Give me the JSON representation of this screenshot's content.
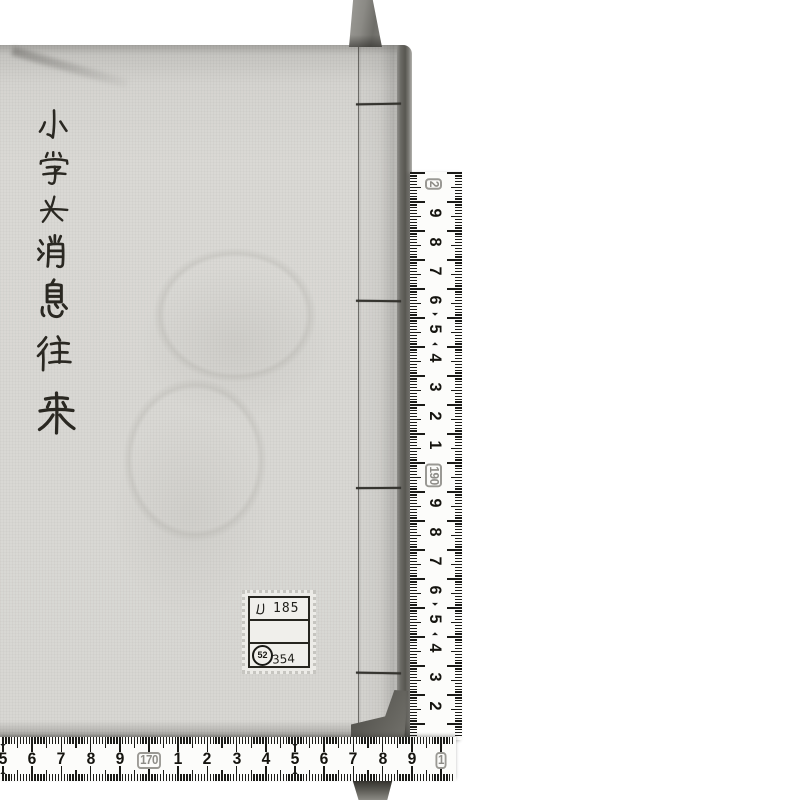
{
  "page": {
    "background_color": "#ffffff"
  },
  "book": {
    "title": "小学女消息往来",
    "title_chars": [
      "小",
      "学",
      "女",
      "消",
      "息",
      "往",
      "来"
    ],
    "cover_color": "#d8d7d3",
    "ink_color": "#2a2822",
    "spine_stitch_count": 4,
    "call_number_label": {
      "line1_kana": "ル",
      "line1_number": "185",
      "line2": "",
      "stamp_circled_number": "52",
      "stamp_number": "354"
    }
  },
  "ribbon": {
    "color": "#7b7a75"
  },
  "rulers": {
    "tape_color": "#fcfcfa",
    "tick_color": "#1b1b18",
    "right_vertical": {
      "orientation": "vertical",
      "values_increase": "upward",
      "marks_top_to_bottom": [
        {
          "value": 200,
          "label": "2",
          "boxed": true
        },
        {
          "value": 199,
          "label": "9"
        },
        {
          "value": 198,
          "label": "8"
        },
        {
          "value": 197,
          "label": "7"
        },
        {
          "value": 196,
          "label": "6"
        },
        {
          "value": 195,
          "label": "5"
        },
        {
          "value": 194,
          "label": "4"
        },
        {
          "value": 193,
          "label": "3"
        },
        {
          "value": 192,
          "label": "2"
        },
        {
          "value": 191,
          "label": "1"
        },
        {
          "value": 190,
          "label": "190",
          "boxed": true
        },
        {
          "value": 189,
          "label": "9"
        },
        {
          "value": 188,
          "label": "8"
        },
        {
          "value": 187,
          "label": "7"
        },
        {
          "value": 186,
          "label": "6"
        },
        {
          "value": 185,
          "label": "5"
        },
        {
          "value": 184,
          "label": "4"
        },
        {
          "value": 183,
          "label": "3"
        },
        {
          "value": 182,
          "label": "2"
        }
      ]
    },
    "bottom_horizontal": {
      "orientation": "horizontal",
      "values_increase": "rightward",
      "marks_left_to_right": [
        {
          "value": 165,
          "label": "5"
        },
        {
          "value": 166,
          "label": "6"
        },
        {
          "value": 167,
          "label": "7"
        },
        {
          "value": 168,
          "label": "8"
        },
        {
          "value": 169,
          "label": "9"
        },
        {
          "value": 170,
          "label": "170",
          "boxed": true
        },
        {
          "value": 171,
          "label": "1"
        },
        {
          "value": 172,
          "label": "2"
        },
        {
          "value": 173,
          "label": "3"
        },
        {
          "value": 174,
          "label": "4"
        },
        {
          "value": 175,
          "label": "5"
        },
        {
          "value": 176,
          "label": "6"
        },
        {
          "value": 177,
          "label": "7"
        },
        {
          "value": 178,
          "label": "8"
        },
        {
          "value": 179,
          "label": "9"
        },
        {
          "value": 180,
          "label": "1",
          "boxed": true
        }
      ]
    }
  }
}
